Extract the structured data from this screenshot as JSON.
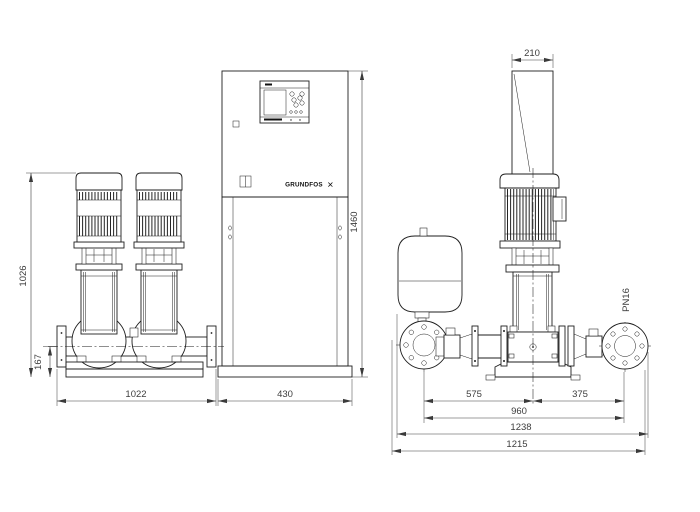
{
  "brand": {
    "logo_text": "GRUNDFOS",
    "logo_mark": "✕"
  },
  "front_view": {
    "dim_pump_height": "1026",
    "dim_manifold_height": "167",
    "dim_pump_base_width": "1022",
    "dim_cabinet_width": "430",
    "dim_cabinet_height": "1460"
  },
  "side_view": {
    "dim_cabinet_depth": "210",
    "dim_suction_to_center": "575",
    "dim_center_to_discharge": "375",
    "dim_flange_span": "960",
    "dim_overall_depth": "1238",
    "dim_base_depth": "1215",
    "pressure_rating": "PN16"
  }
}
